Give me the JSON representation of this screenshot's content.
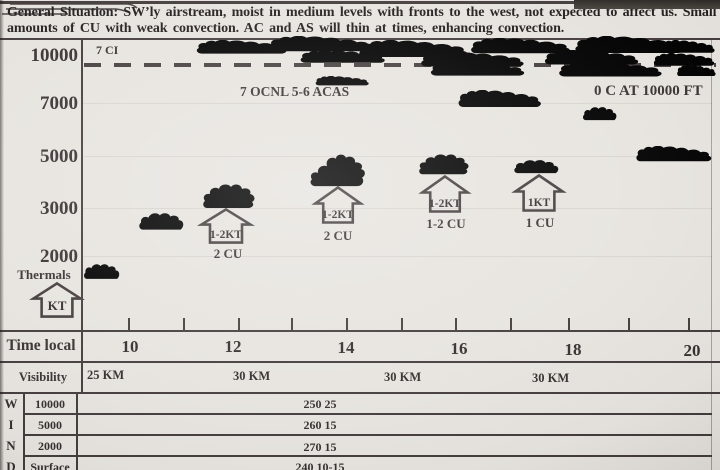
{
  "header": {
    "line1": "General Situation: SW’ly airstream, moist in medium levels with fronts to the west, not expected to affect us. Small",
    "line2": "amounts of CU with weak convection. AC and AS will thin at times, enhancing convection."
  },
  "altitude_axis": {
    "labels": [
      "10000",
      "7000",
      "5000",
      "3000",
      "2000"
    ],
    "thermals_label": "Thermals",
    "kt_label": "KT"
  },
  "upper_air": {
    "ci_label": "7 CI",
    "acas_label": "7 OCNL 5-6 ACAS",
    "freezing_label": "0 C AT 10000 FT"
  },
  "thermals": [
    {
      "strength": "1-2KT",
      "cu": "2 CU"
    },
    {
      "strength": "1-2KT",
      "cu": "2 CU"
    },
    {
      "strength": "1-2KT",
      "cu": "1-2 CU"
    },
    {
      "strength": "1KT",
      "cu": "1 CU"
    }
  ],
  "time_axis": {
    "label": "Time local",
    "ticks": [
      "10",
      "12",
      "14",
      "16",
      "18",
      "20"
    ]
  },
  "visibility": {
    "label": "Visibility",
    "values": [
      "25 KM",
      "30 KM",
      "30 KM",
      "30 KM"
    ]
  },
  "wind_table": {
    "rows": [
      {
        "letter": "W",
        "level": "10000",
        "value": "250 25"
      },
      {
        "letter": "I",
        "level": "5000",
        "value": "260 15"
      },
      {
        "letter": "N",
        "level": "2000",
        "value": "270 15"
      },
      {
        "letter": "D",
        "level": "Surface",
        "value": "240 10-15"
      }
    ]
  },
  "colors": {
    "paper": "#e7e4df",
    "ink": "#3a3233"
  },
  "chart_data": {
    "type": "table",
    "title": "Soaring weather meteogram (cloud, thermals, visibility, wind vs local time)",
    "xlabel": "Time local",
    "ylabel": "Altitude (ft)",
    "x_ticks": [
      10,
      11,
      12,
      13,
      14,
      15,
      16,
      17,
      18,
      19,
      20
    ],
    "x_labeled_ticks": [
      10,
      12,
      14,
      16,
      18,
      20
    ],
    "y_ticks": [
      10000,
      7000,
      5000,
      3000,
      2000
    ],
    "general_situation": "SW'ly airstream, moist in medium levels with fronts to the west, not expected to affect us. Small amounts of CU with weak convection. AC and AS will thin at times, enhancing convection.",
    "cloud_layers": [
      {
        "name": "CI",
        "label": "7 CI",
        "level_ft": 10000
      },
      {
        "name": "AC/AS",
        "label": "7 OCNL 5-6 ACAS",
        "level_ft_approx": 8500
      }
    ],
    "freezing_level": "0 C AT 10000 FT",
    "thermals": [
      {
        "time_local": 12,
        "strength": "1-2KT",
        "cumulus": "2 CU",
        "top_ft_approx": 3000
      },
      {
        "time_local": 14,
        "strength": "1-2KT",
        "cumulus": "2 CU",
        "top_ft_approx": 3400
      },
      {
        "time_local": 16,
        "strength": "1-2KT",
        "cumulus": "1-2 CU",
        "top_ft_approx": 3500
      },
      {
        "time_local": 18,
        "strength": "1KT",
        "cumulus": "1 CU",
        "top_ft_approx": 3500
      }
    ],
    "visibility": [
      "25 KM",
      "30 KM",
      "30 KM",
      "30 KM"
    ],
    "wind": [
      {
        "level": "10000",
        "value": "250 25"
      },
      {
        "level": "5000",
        "value": "260 15"
      },
      {
        "level": "2000",
        "value": "270 15"
      },
      {
        "level": "Surface",
        "value": "240 10-15"
      }
    ]
  }
}
